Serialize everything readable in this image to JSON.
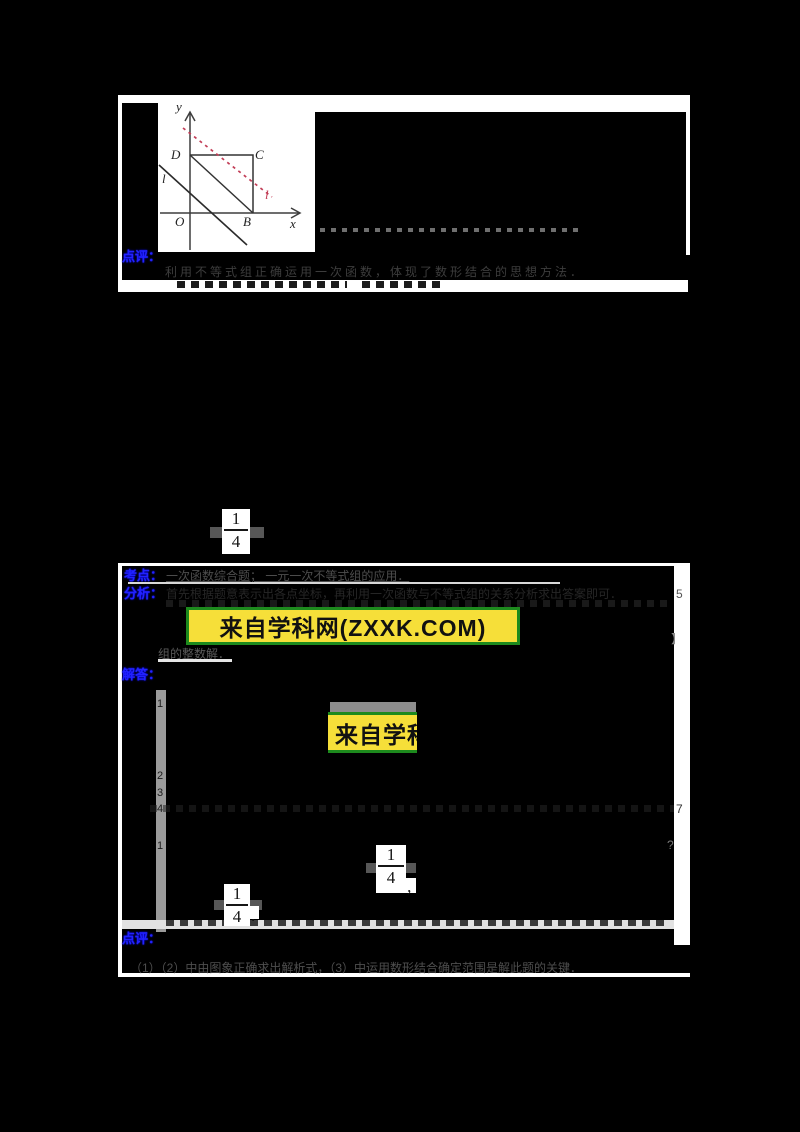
{
  "colors": {
    "page_bg": "#000000",
    "panel_white": "#ffffff",
    "label_blue": "#2222ff",
    "watermark_yellow": "#f6df39",
    "watermark_green_border": "#1d8a1d",
    "figure_red_line": "#c23e57"
  },
  "top_panel": {
    "answer_line": "故选：D．",
    "figure": {
      "axis_label_y": "y",
      "axis_label_x": "x",
      "point_O": "O",
      "point_B": "B",
      "point_C": "C",
      "point_D": "D",
      "black_line_label": "l",
      "red_line_label": "l"
    },
    "comment_label": "点评：",
    "comment_text": "利用不等式组正确运用一次函数，体现了数形结合的思想方法．"
  },
  "mid_fraction": {
    "numerator": "1",
    "denominator": "4"
  },
  "sections": {
    "kaodian": {
      "label": "考点：",
      "text": "一次函数综合题；  一元一次不等式组的应用．"
    },
    "fenxi": {
      "label": "分析：",
      "text": "首先根据题意表示出各点坐标，再利用一次函数与不等式组的关系分析求出答案即可．",
      "margin_glyph": "5"
    },
    "watermark_full": "来自学科网(ZXXK.COM)",
    "post_watermark_text": "组的整数解．",
    "jieda": {
      "label": "解答：",
      "line_numbers": [
        "1",
        "2",
        "3",
        "4",
        "1"
      ],
      "margin_bracket": "】",
      "margin_question": "?",
      "margin_seven": "7"
    },
    "watermark_clipped": "来自学科网",
    "frac2": {
      "numerator": "1",
      "denominator": "4",
      "suffix": "，"
    },
    "frac3": {
      "numerator": "1",
      "denominator": "4",
      "suffix": "．"
    },
    "dianping": {
      "label": "点评：",
      "text": "（1）（2）中由图象正确求出解析式，（3）中运用数形结合确定范围是解此题的关键．"
    }
  }
}
